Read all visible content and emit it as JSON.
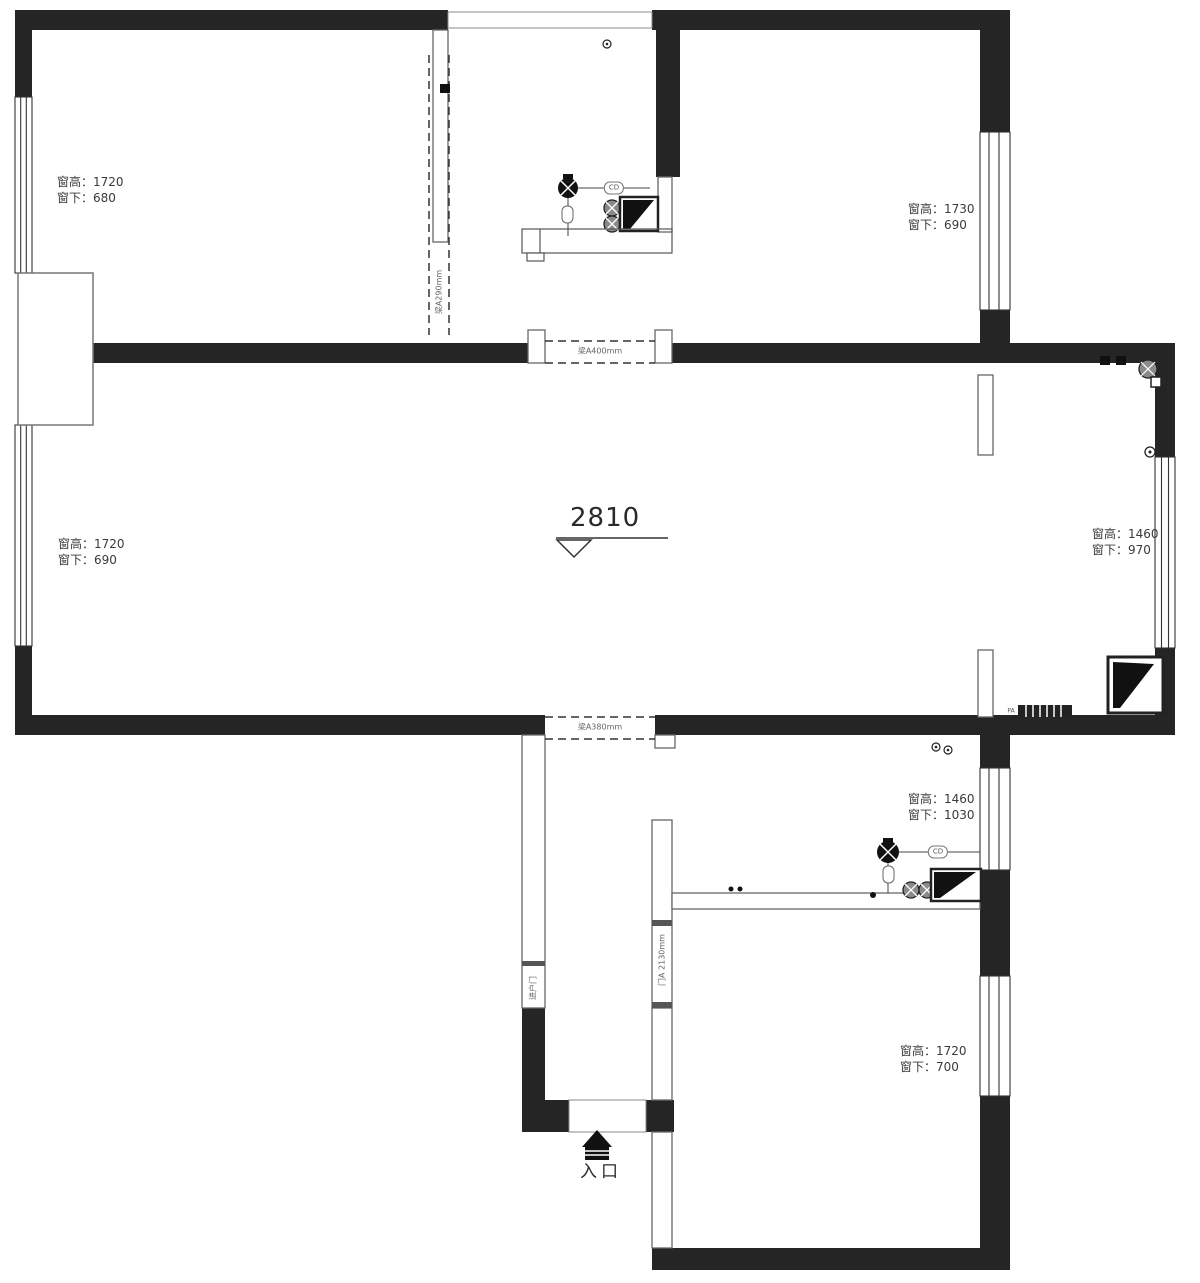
{
  "title": "apartment-floor-plan",
  "colors": {
    "wall": "#252525",
    "line": "#4a4a4a",
    "text": "#3a3a3a",
    "bg": "#ffffff"
  },
  "labels": {
    "win_top_left": {
      "l1": "窗高：1720",
      "l2": "窗下：680"
    },
    "win_top_right": {
      "l1": "窗高：1730",
      "l2": "窗下：690"
    },
    "win_mid_left": {
      "l1": "窗高：1720",
      "l2": "窗下：690"
    },
    "win_mid_right": {
      "l1": "窗高：1460",
      "l2": "窗下：970"
    },
    "win_bottom_right_upper": {
      "l1": "窗高：1460",
      "l2": "窗下：1030"
    },
    "win_bottom_right_lower": {
      "l1": "窗高：1720",
      "l2": "窗下：700"
    },
    "ceiling_height": "2810",
    "entrance": "入口",
    "beam_top_opening": "梁A400mm",
    "beam_bottom_opening": "梁A380mm",
    "beam_kitchen": "梁A290mm",
    "door_opening": "门A 2130mm",
    "entry_door": "进户门",
    "pipe_tag_kitchen": "CD",
    "pipe_tag_bath": "CD",
    "radiator_tag": "PA"
  }
}
